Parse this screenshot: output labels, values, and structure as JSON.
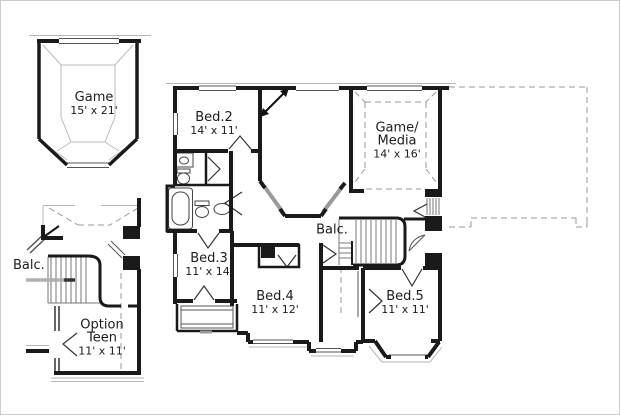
{
  "plan": {
    "type": "floor-plan-second-floor",
    "colors": {
      "wall": "#1a1a1a",
      "thin_line": "#555555",
      "light_line": "#b5b5b5",
      "dashed_line": "#999999",
      "gray_wall": "#9a9a9a",
      "text": "#1c1c1c",
      "background": "#ffffff"
    },
    "rooms": [
      {
        "id": "game",
        "name": "Game",
        "dims": "15' x 21'"
      },
      {
        "id": "bed2",
        "name": "Bed.2",
        "dims": "14' x 11'"
      },
      {
        "id": "game_media",
        "name": "Game/\nMedia",
        "dims": "14' x 16'"
      },
      {
        "id": "balcony_left",
        "name": "Balc.",
        "dims": ""
      },
      {
        "id": "option_teen",
        "name": "Option\nTeen",
        "dims": "11' x 11'"
      },
      {
        "id": "balcony_center",
        "name": "Balc.",
        "dims": ""
      },
      {
        "id": "bed3",
        "name": "Bed.3",
        "dims": "11' x 14'"
      },
      {
        "id": "bed4",
        "name": "Bed.4",
        "dims": "11' x 12'"
      },
      {
        "id": "bed5",
        "name": "Bed.5",
        "dims": "11' x 11'"
      }
    ]
  }
}
